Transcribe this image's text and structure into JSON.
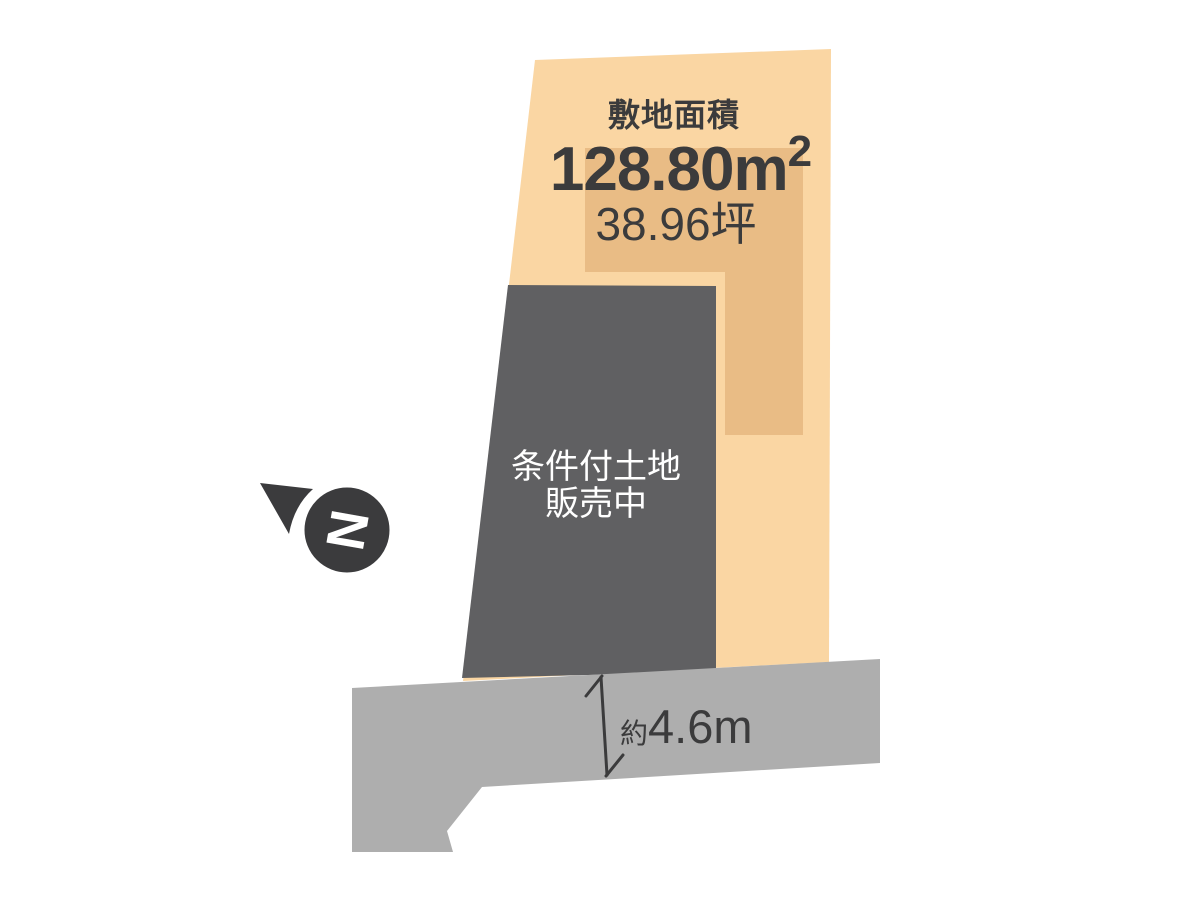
{
  "diagram": {
    "title": "land-plot-sales-diagram",
    "site_area": {
      "label": "敷地面積",
      "value": "128.80",
      "unit": "m",
      "power": "2",
      "tsubo": "38.96坪"
    },
    "plot_status": {
      "line1": "条件付土地",
      "line2": "販売中"
    },
    "road": {
      "width_prefix": "約",
      "width_value": "4.6m"
    },
    "compass": {
      "letter": "N"
    },
    "colors": {
      "background": "#FFFFFF",
      "parcel": "#FAD6A3",
      "parcel_inner": "#E9BC85",
      "plot": "#606062",
      "road": "#AEAEAE",
      "ink": "#3B3B3C",
      "status_text": "#FFFFFF"
    }
  }
}
